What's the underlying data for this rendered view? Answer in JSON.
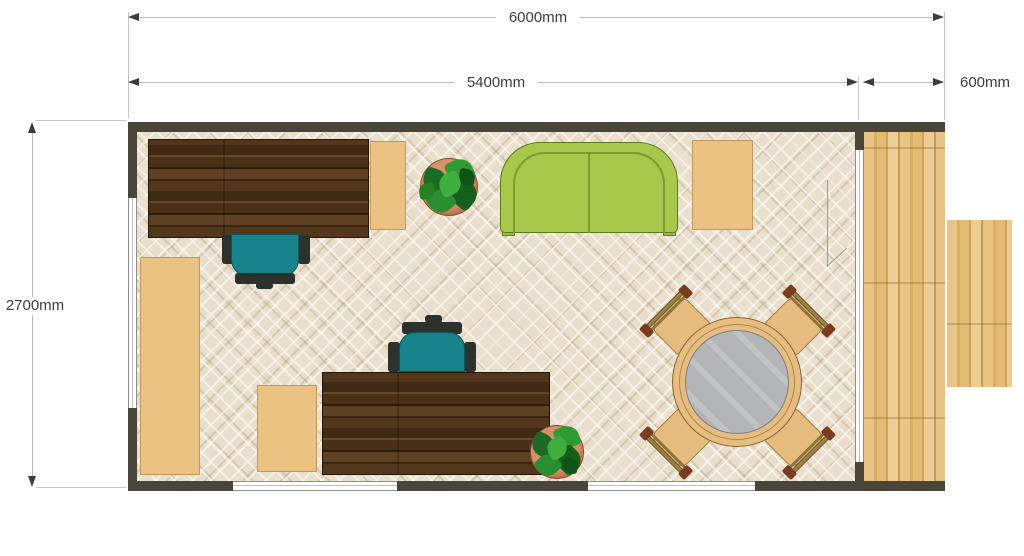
{
  "dimensions": {
    "overall_width": "6000mm",
    "room_width": "5400mm",
    "porch_width": "600mm",
    "room_depth": "2700mm"
  },
  "colors": {
    "wall": "#4a453a",
    "floor_base": "#e9dfcc",
    "deck_wood": "#e3bb76",
    "desk_wood": "#4c3219",
    "sofa_green": "#a7c84b",
    "office_chair_teal": "#17828a",
    "side_table_tan": "#ecc283",
    "dining_table_top": "#b3b5b7",
    "plant_green": "#2a8f30",
    "plant_pot": "#c77f5f",
    "dimension_text": "#3c3c3c"
  }
}
